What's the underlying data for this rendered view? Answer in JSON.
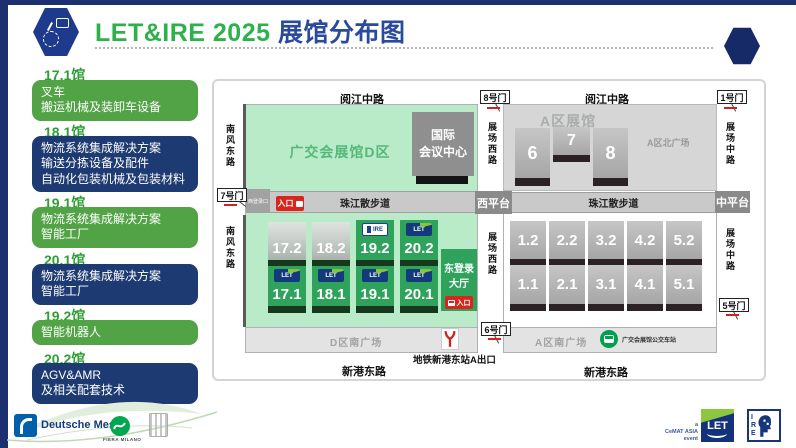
{
  "header": {
    "title_left": "LET&IRE 2025",
    "title_right": " 展馆分布图"
  },
  "sidebar": {
    "items": [
      {
        "hall": "17.1馆",
        "variant": "green",
        "lines": [
          "叉车",
          "搬运机械及装卸车设备"
        ]
      },
      {
        "hall": "18.1馆",
        "variant": "navy",
        "lines": [
          "物流系统集成解决方案",
          "输送分拣设备及配件",
          "自动化包装机械及包装材料"
        ]
      },
      {
        "hall": "19.1馆",
        "variant": "green",
        "lines": [
          "物流系统集成解决方案",
          "智能工厂"
        ]
      },
      {
        "hall": "20.1馆",
        "variant": "navy",
        "lines": [
          "物流系统集成解决方案",
          "智能工厂"
        ]
      },
      {
        "hall": "19.2馆",
        "variant": "green",
        "lines": [
          "智能机器人"
        ]
      },
      {
        "hall": "20.2馆",
        "variant": "navy",
        "lines": [
          "AGV&AMR",
          "及相关配套技术"
        ]
      }
    ]
  },
  "map": {
    "roads": {
      "yuejiang": "阅江中路",
      "nanfeng": "南风东路",
      "zhanchang_xi": "展场西路",
      "zhanchang_zhong": "展场中路",
      "xingang": "新港东路",
      "zhujiang": "珠江散步道"
    },
    "gates": {
      "g1": "1号门",
      "g5": "5号门",
      "g6": "6号门",
      "g7": "7号门",
      "g8": "8号门"
    },
    "d_zone": {
      "area_title": "广交会展馆D区",
      "conv_center_lines": [
        "国际",
        "会议中心"
      ],
      "west_login": "西登录口",
      "entrance_label": "入口",
      "east_hall_lines": [
        "东登录",
        "大厅"
      ],
      "east_hall_entrance": "入口",
      "south_plaza": "D区南广场",
      "metro_exit": "地铁新港东站A出口",
      "halls_top": [
        "17.2",
        "18.2",
        "19.2",
        "20.2"
      ],
      "halls_bottom": [
        "17.1",
        "18.1",
        "19.1",
        "20.1"
      ]
    },
    "a_zone": {
      "area_title": "A区展馆",
      "north_plaza": "A区北广场",
      "north_halls": [
        "6",
        "7",
        "8"
      ],
      "west_platform": "西平台",
      "mid_platform": "中平台",
      "halls_top": [
        "1.2",
        "2.2",
        "3.2",
        "4.2",
        "5.2"
      ],
      "halls_bottom": [
        "1.1",
        "2.1",
        "3.1",
        "4.1",
        "5.1"
      ],
      "south_plaza": "A区南广场",
      "bus_station": "广交会展馆公交车站"
    }
  },
  "logos": {
    "let_small": "LET",
    "ire_small": "IRE"
  },
  "footer": {
    "deutsche_messe": "Deutsche Messe",
    "fiera_milano": "FIERA MILANO",
    "cemat_lines": [
      "a",
      "CeMAT ASIA",
      "event"
    ],
    "let_logo_text": "LET",
    "ire_letters": [
      "I",
      "R",
      "E"
    ]
  },
  "colors": {
    "navy": "#1c2f6e",
    "title_green": "#2db14a",
    "title_blue": "#2a4a9e",
    "box_green": "#52a346",
    "box_navy": "#1d3a72",
    "d_area_green": "#b9ebc8",
    "hall_green": "#2fa35c",
    "red": "#da251c",
    "bus_green": "#00a04d"
  }
}
